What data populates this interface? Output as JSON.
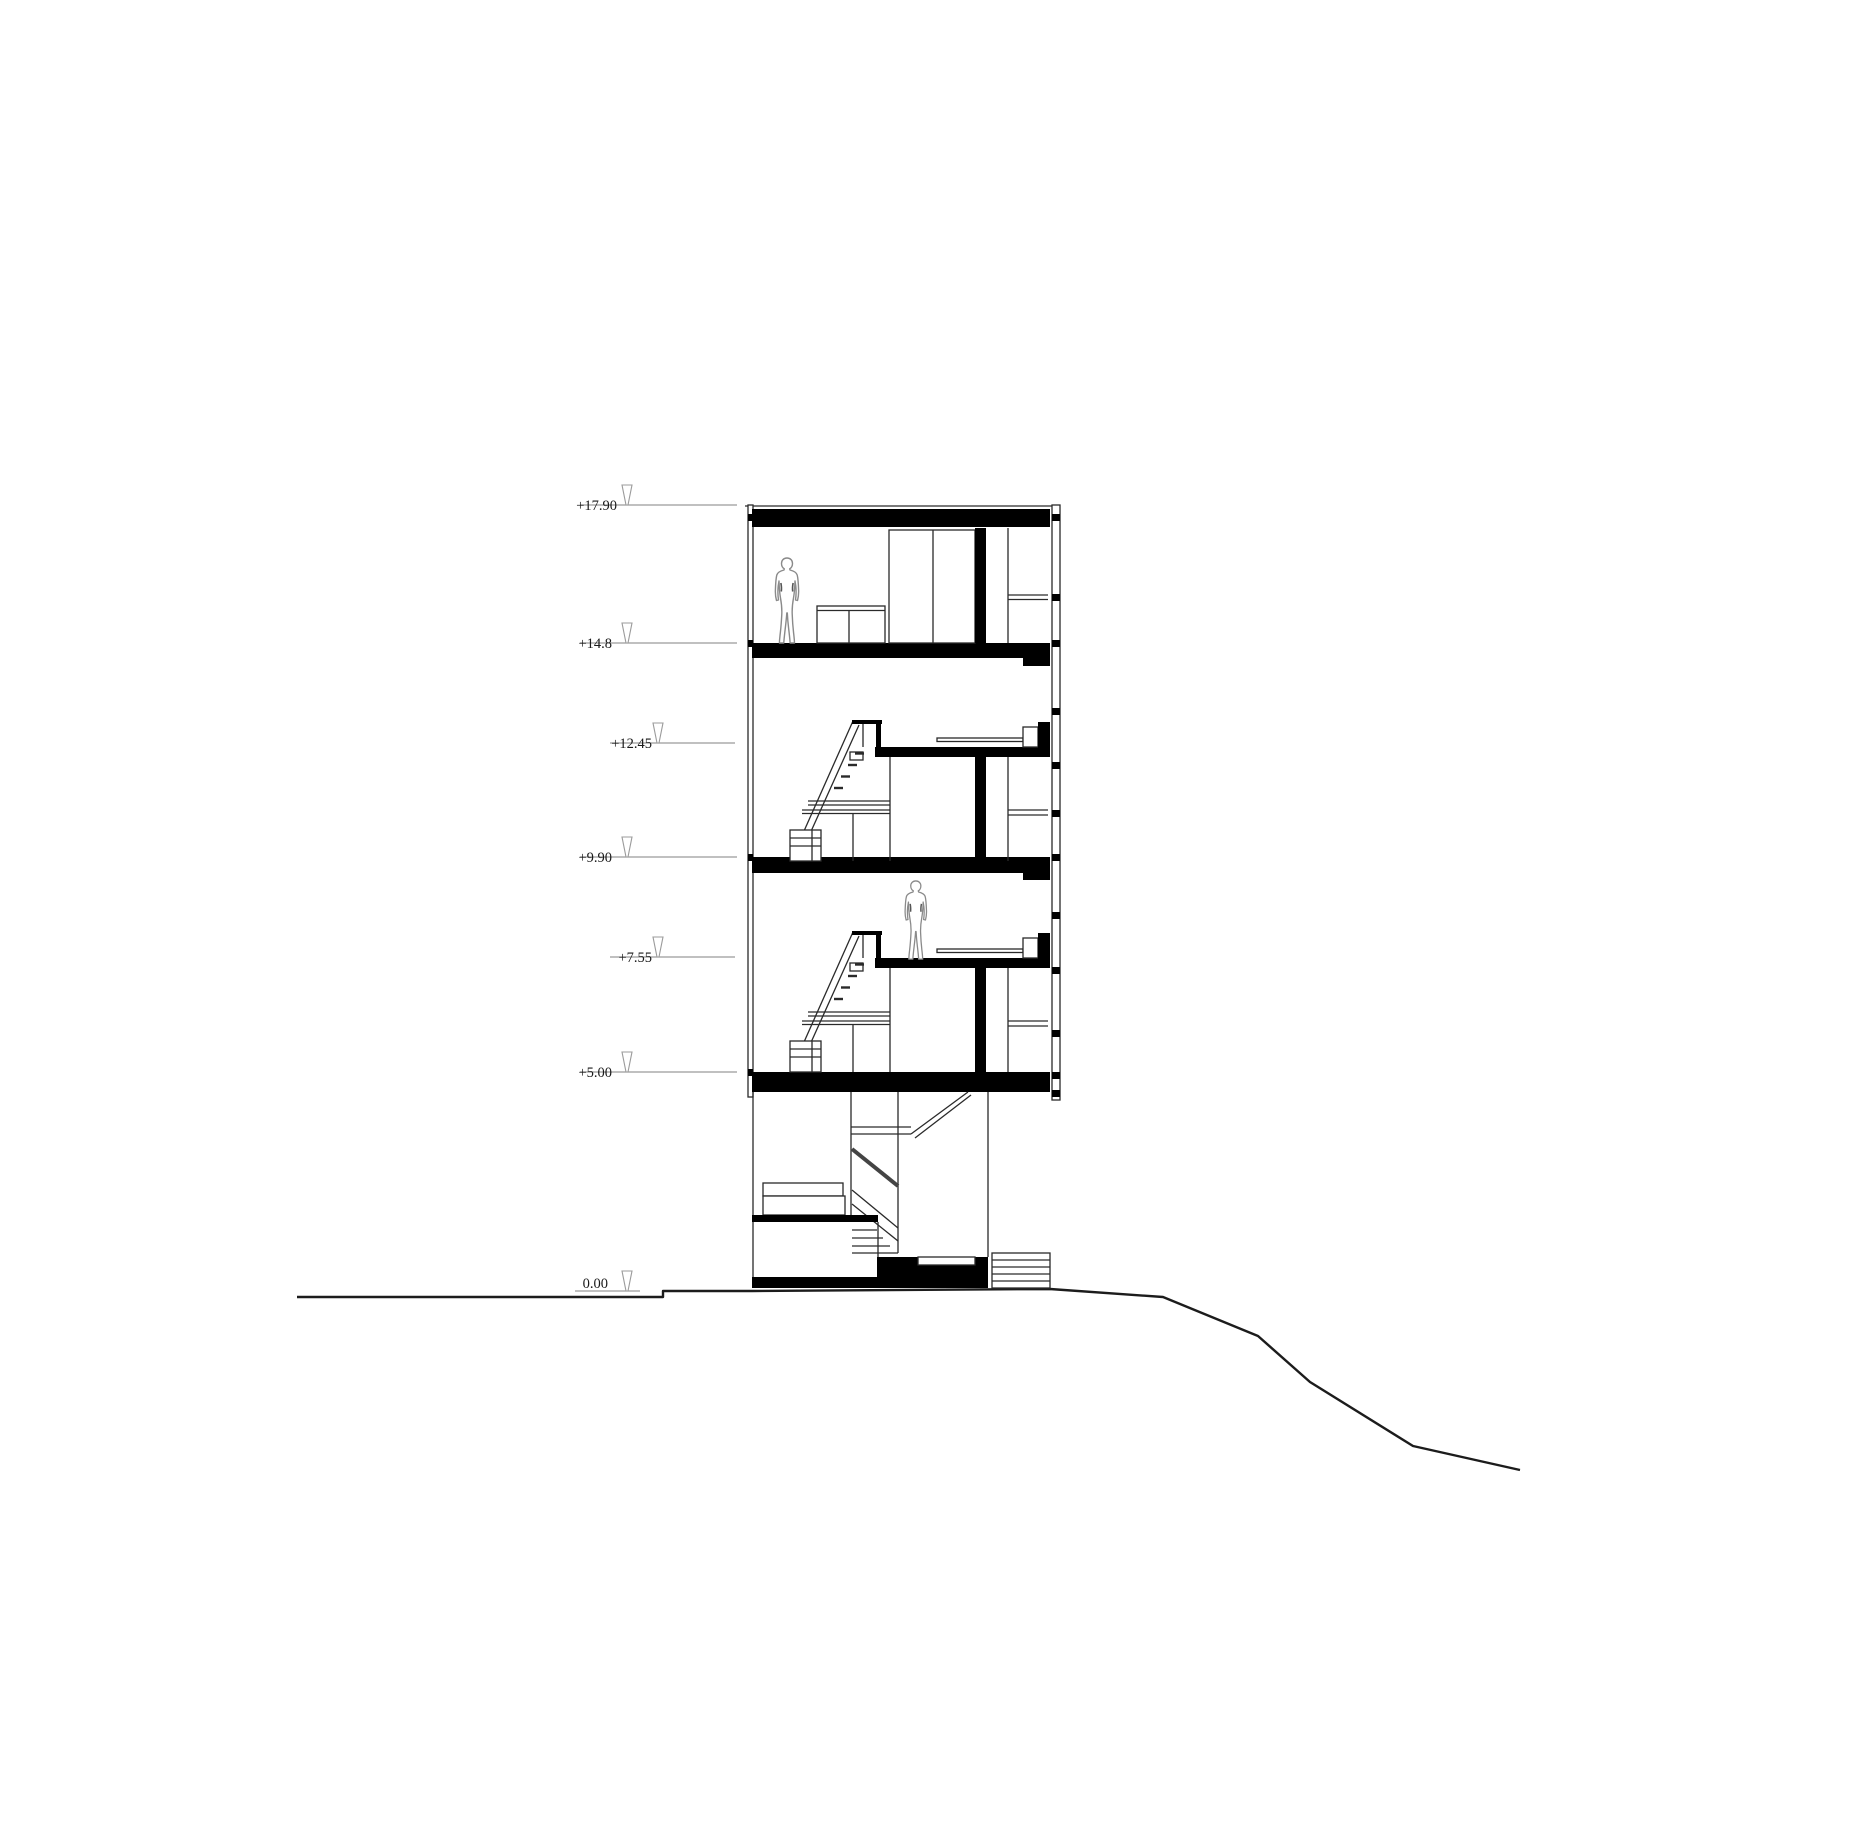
{
  "drawing": {
    "kind": "architectural cross-section",
    "elevation_markers": [
      {
        "label": "+17.90"
      },
      {
        "label": "+14.8"
      },
      {
        "label": "+12.45"
      },
      {
        "label": "+9.90"
      },
      {
        "label": "+7.55"
      },
      {
        "label": "+5.00"
      },
      {
        "label": "0.00"
      }
    ]
  },
  "icons": {
    "level_marker": "open-inverted-triangle"
  },
  "colors": {
    "background": "#ffffff",
    "ink": "#000000",
    "line": "#2a2a2a",
    "marker": "#9b9b9b",
    "ground": "#1c1c1c",
    "figure_outline": "#8a8a8a"
  }
}
